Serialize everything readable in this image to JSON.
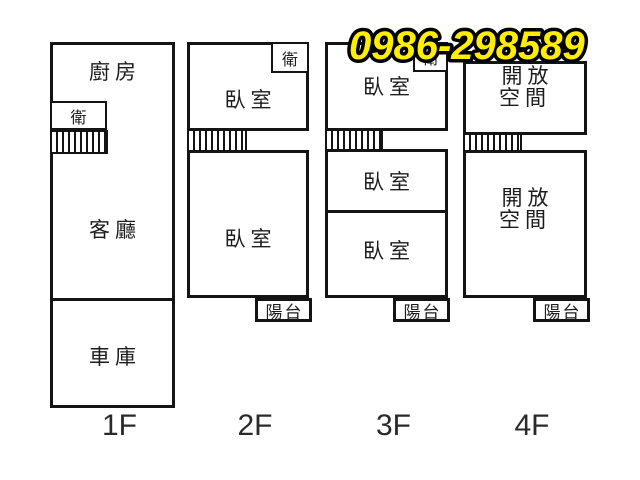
{
  "phone": {
    "number": "0986-298589",
    "fill_color": "#ffee00",
    "outline_color": "#000000"
  },
  "colors": {
    "wall_line": "#141414",
    "background": "#ffffff"
  },
  "floors": [
    {
      "label": "1F",
      "rooms": {
        "kitchen": "廚房",
        "bath": "衛",
        "living": "客廳",
        "garage": "車庫"
      }
    },
    {
      "label": "2F",
      "rooms": {
        "bath": "衛",
        "bedroom_upper": "臥室",
        "bedroom_lower": "臥室",
        "balcony": "陽台"
      }
    },
    {
      "label": "3F",
      "rooms": {
        "bath": "衛",
        "bedroom_top": "臥室",
        "bedroom_mid": "臥室",
        "bedroom_low": "臥室",
        "balcony": "陽台"
      }
    },
    {
      "label": "4F",
      "rooms": {
        "open_upper": "開放空間",
        "open_lower": "開放空間",
        "balcony": "陽台"
      }
    }
  ]
}
